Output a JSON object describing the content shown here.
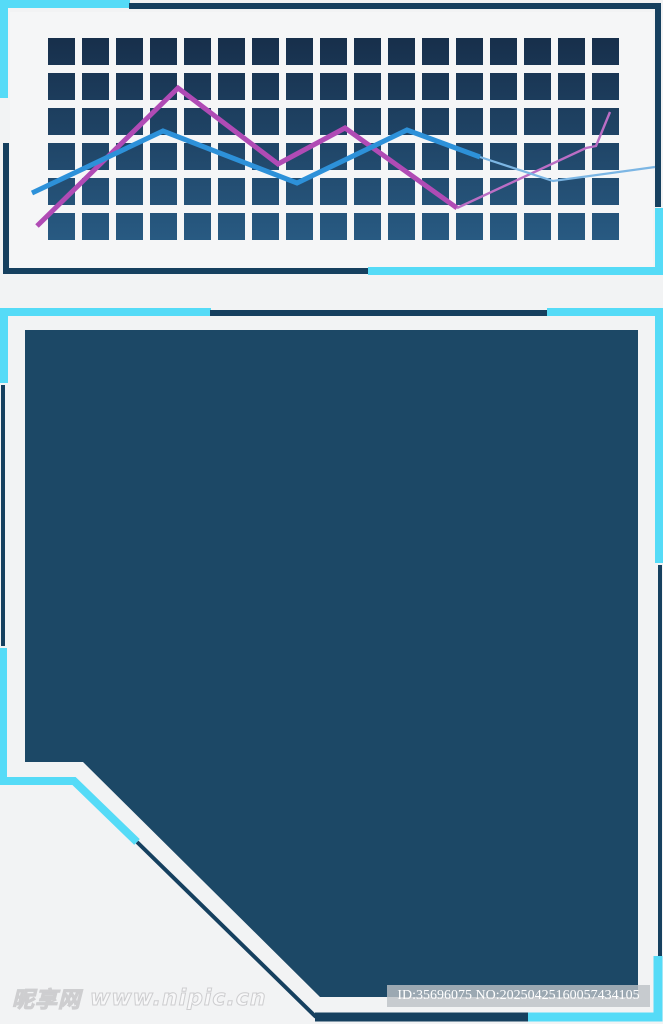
{
  "page": {
    "width": 663,
    "height": 1024,
    "background": "#f2f3f4"
  },
  "palette": {
    "accent_cyan": "#55dbf7",
    "accent_navy": "#16405f",
    "panel_navy": "#1c4866",
    "grid_tile_top": "#172f4b",
    "grid_tile_bottom": "#285a82",
    "chart_blue": "#2d91d9",
    "chart_blue_thin": "#7cb6e4",
    "chart_magenta": "#b04bb5",
    "chart_magenta_thin": "#bb6ec5",
    "panel_white": "#f5f6f7"
  },
  "top_chart": {
    "grid": {
      "columns": 17,
      "rows": 6,
      "cell_size": 27,
      "gap_x": 7,
      "gap_y": 8
    },
    "series": [
      {
        "name": "magenta-thick",
        "points": "37,226 178,88 278,164 345,128 457,208"
      },
      {
        "name": "magenta-thin",
        "points": "457,208 586,148 596,146 610,112"
      },
      {
        "name": "blue-thick",
        "points": "32,193 163,131 297,183 407,130 480,157"
      },
      {
        "name": "blue-thin",
        "points": "480,157 553,181 655,167"
      }
    ]
  },
  "frame_paths": {
    "top_cyan_top_left": "M0,4 H130 M4,0 V98",
    "top_navy_top_right": "M129,6 H658 V207",
    "top_navy_bottom_left": "M6,143 V271 H368",
    "top_cyan_bottom_right": "M659,208 V271 M368,271 H663",
    "bottom_cyan_top_left": "M0,312 H211",
    "bottom_navy_top": "M210,313 H548",
    "bottom_cyan_top_right": "M547,312 H659 V563",
    "bottom_navy_right": "M660,565 V957",
    "bottom_cyan_bottom_right": "M658,956 V1017 H526",
    "bottom_navy_bottom": "M528,1017 H315",
    "bottom_navy_diagonal": "M316,1017 L137,842",
    "bottom_cyan_bottom_left": "M3,648 V781 H74 L137,842",
    "bottom_navy_left": "M3,385 V646",
    "bottom_cyan_left": "M4,308 V383"
  },
  "branding": {
    "watermark_site": "昵享网",
    "watermark_url": "www.nipic.cn"
  },
  "id_bar": {
    "text": "ID:35696075 NO:20250425160057434105"
  }
}
